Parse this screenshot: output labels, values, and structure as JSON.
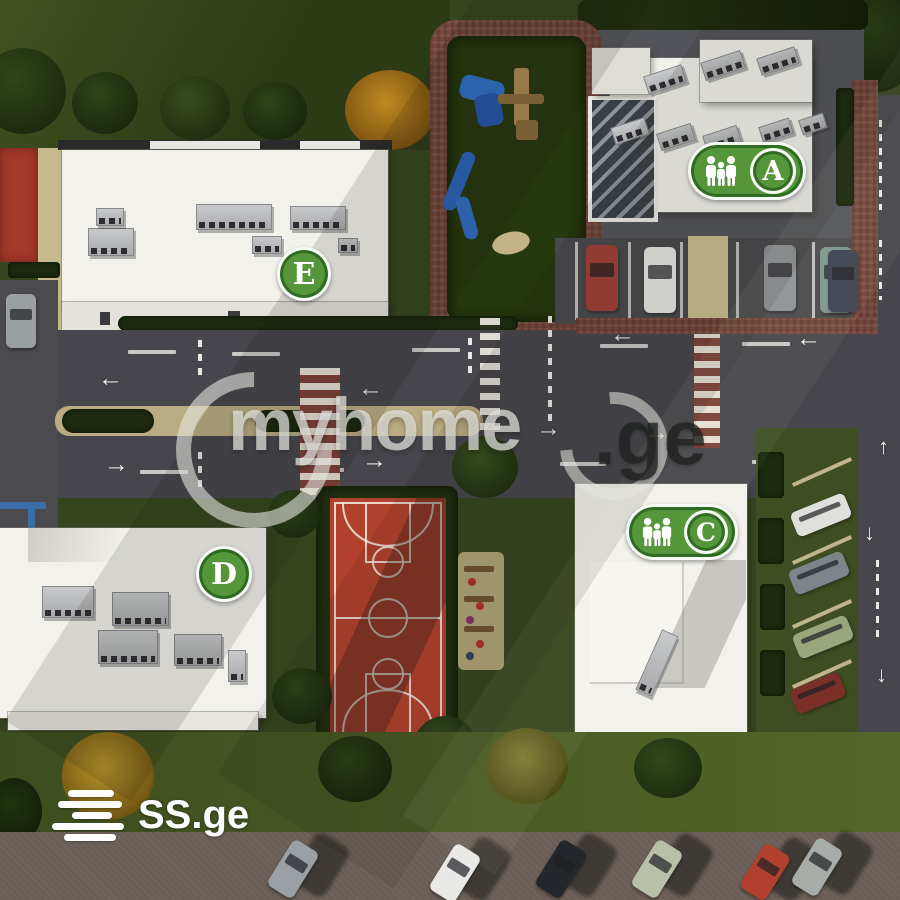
{
  "buildings": [
    {
      "id": "building-e",
      "label": "E",
      "badge_type": "circle"
    },
    {
      "id": "building-a",
      "label": "A",
      "badge_type": "family-pill"
    },
    {
      "id": "building-d",
      "label": "D",
      "badge_type": "circle"
    },
    {
      "id": "building-c",
      "label": "C",
      "badge_type": "family-pill"
    }
  ],
  "watermark": {
    "brand": "myhome",
    "tld": ".ge"
  },
  "logo": {
    "text": "SS.ge"
  },
  "glyphs": {
    "arrow_left": "←",
    "arrow_right": "→",
    "arrow_down": "↓",
    "arrow_up": "↑"
  },
  "icons": {
    "family-icon": "three-person-family-silhouette",
    "wheelchair-icon": "accessible-parking-wheelchair"
  },
  "colors": {
    "badge_green": "#56963a",
    "court_red": "#b1402c",
    "handicap_blue": "#2e66b5",
    "grass": "#36451f",
    "road": "#46464c",
    "brick_path": "#74453a"
  }
}
